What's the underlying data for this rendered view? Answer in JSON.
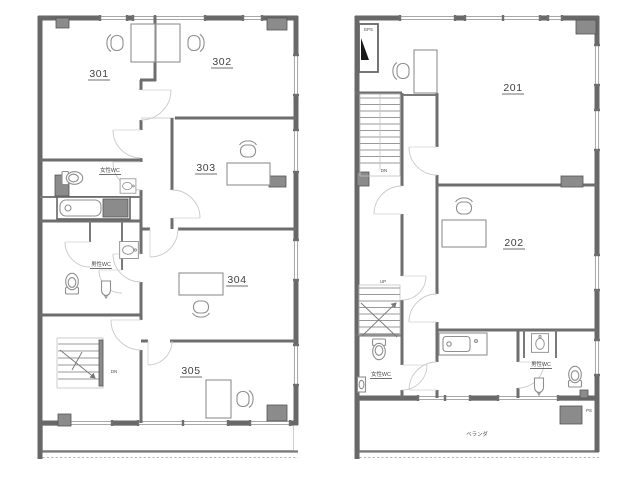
{
  "document_type": "architectural-floor-plans",
  "colors": {
    "background": "#ffffff",
    "wall": "#686868",
    "column_fill": "#8b8b8b",
    "window_line": "#9c9c9c",
    "fixture_line": "#8f8f8f",
    "door_arc": "#c9c9c9",
    "text": "#3f3f3f"
  },
  "plan_left": {
    "rooms": [
      {
        "label": "301"
      },
      {
        "label": "302"
      },
      {
        "label": "303"
      },
      {
        "label": "304"
      },
      {
        "label": "305"
      }
    ],
    "labels": {
      "wc_female": "女性WC",
      "wc_male": "男性WC",
      "stairs_down": "DN"
    }
  },
  "plan_right": {
    "rooms": [
      {
        "label": "201"
      },
      {
        "label": "202"
      }
    ],
    "labels": {
      "wc_female": "女性WC",
      "wc_male": "男性WC",
      "stairs_down": "DN",
      "stairs_up": "UP",
      "shaft_eps": "EPS",
      "shaft_ps": "PS",
      "balcony": "ベランダ"
    }
  }
}
